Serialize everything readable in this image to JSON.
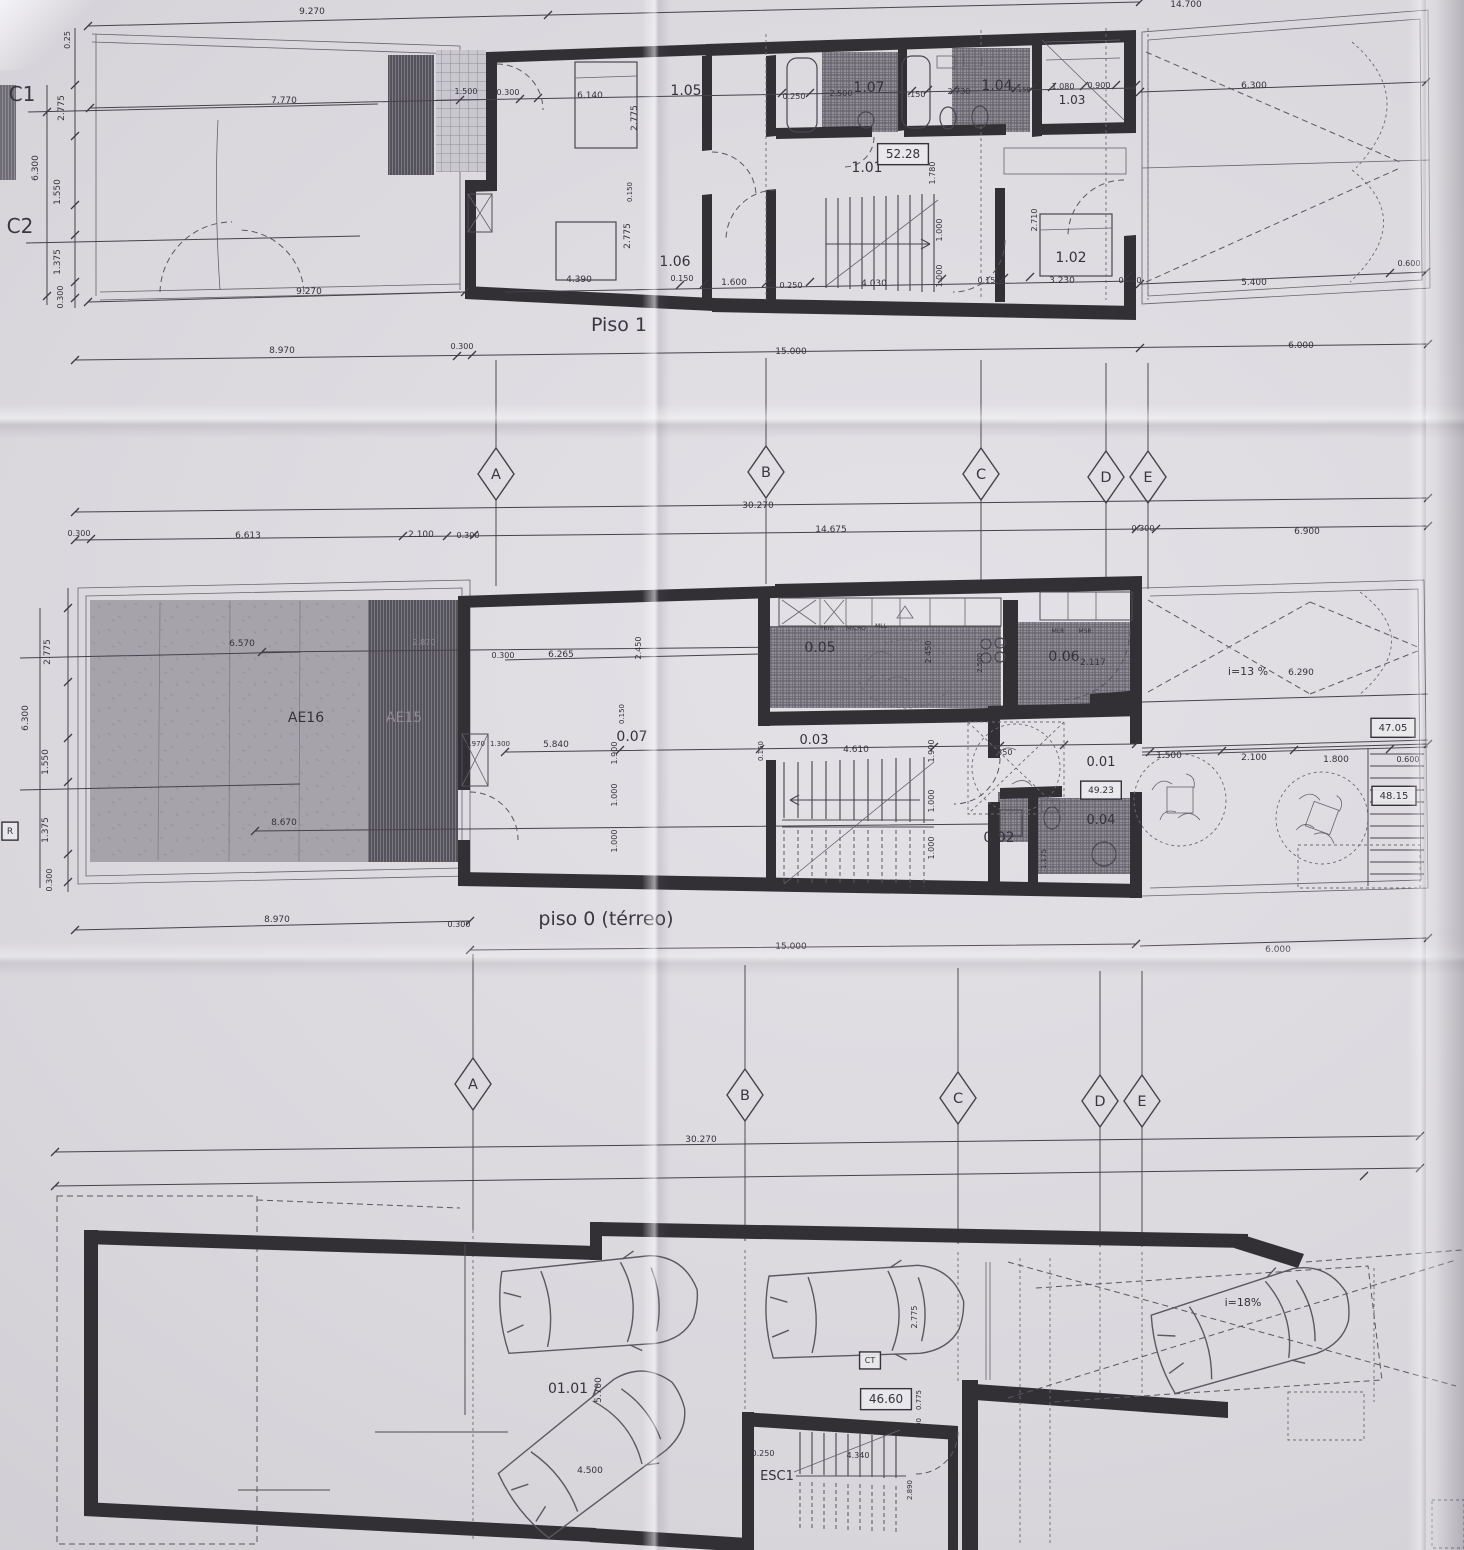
{
  "meta": {
    "kind": "architectural floor plan scan",
    "colors": {
      "paper": "#d8d6db",
      "ink": "#35323a",
      "wall": "#322f35",
      "patio_gray": "#a5a2a9",
      "stripe_dark": "#6e6b72"
    }
  },
  "grid": {
    "row1": {
      "letters": [
        "A",
        "B",
        "C",
        "D",
        "E"
      ],
      "x": [
        496,
        766,
        981,
        1106,
        1148
      ],
      "y": [
        474,
        472,
        474,
        477,
        477
      ]
    },
    "row2": {
      "letters": [
        "A",
        "B",
        "C",
        "D",
        "E"
      ],
      "x": [
        473,
        745,
        958,
        1100,
        1142
      ],
      "y": [
        1084,
        1095,
        1098,
        1101,
        1101
      ]
    }
  },
  "labels": {
    "piso1": [
      {
        "t": "9.270",
        "x": 312,
        "y": 14,
        "s": 9
      },
      {
        "t": "14.700",
        "x": 1186,
        "y": 7,
        "s": 9
      },
      {
        "t": "C1",
        "x": 22,
        "y": 101,
        "s": 20,
        "c": "grid"
      },
      {
        "t": "C2",
        "x": 20,
        "y": 233,
        "s": 20,
        "c": "grid"
      },
      {
        "t": "0.25",
        "x": 70,
        "y": 40,
        "r": -90,
        "s": 8
      },
      {
        "t": "2.775",
        "x": 64,
        "y": 108,
        "r": -90,
        "s": 9
      },
      {
        "t": "6.300",
        "x": 38,
        "y": 168,
        "r": -90,
        "s": 9
      },
      {
        "t": "1.550",
        "x": 60,
        "y": 192,
        "r": -90,
        "s": 9
      },
      {
        "t": "1.375",
        "x": 60,
        "y": 262,
        "r": -90,
        "s": 9
      },
      {
        "t": "0.300",
        "x": 63,
        "y": 297,
        "r": -90,
        "s": 8
      },
      {
        "t": "7.770",
        "x": 284,
        "y": 103,
        "s": 9
      },
      {
        "t": "1.500",
        "x": 466,
        "y": 94,
        "s": 8
      },
      {
        "t": "0.300",
        "x": 508,
        "y": 95,
        "s": 8
      },
      {
        "t": "6.140",
        "x": 590,
        "y": 98,
        "s": 9
      },
      {
        "t": "1.05",
        "x": 686,
        "y": 95,
        "s": 14,
        "c": "room"
      },
      {
        "t": "0.250",
        "x": 794,
        "y": 99,
        "s": 8
      },
      {
        "t": "2.500",
        "x": 841,
        "y": 96,
        "s": 8
      },
      {
        "t": "1.07",
        "x": 869,
        "y": 92,
        "s": 14,
        "c": "room"
      },
      {
        "t": "0.150",
        "x": 914,
        "y": 97,
        "s": 8
      },
      {
        "t": "2.730",
        "x": 959,
        "y": 94,
        "s": 8
      },
      {
        "t": "1.04",
        "x": 997,
        "y": 90,
        "s": 14,
        "c": "room"
      },
      {
        "t": "0.150",
        "x": 1021,
        "y": 92,
        "s": 7
      },
      {
        "t": "1.080",
        "x": 1063,
        "y": 89,
        "s": 8
      },
      {
        "t": "0.900",
        "x": 1099,
        "y": 88,
        "s": 8
      },
      {
        "t": "1.03",
        "x": 1072,
        "y": 104,
        "s": 12,
        "c": "room"
      },
      {
        "t": "6.300",
        "x": 1254,
        "y": 88,
        "s": 9
      },
      {
        "t": "2.775",
        "x": 637,
        "y": 118,
        "r": -90,
        "s": 9
      },
      {
        "t": "0.150",
        "x": 632,
        "y": 192,
        "r": -90,
        "s": 7
      },
      {
        "t": "2.775",
        "x": 630,
        "y": 236,
        "r": -90,
        "s": 9
      },
      {
        "t": "1.780",
        "x": 935,
        "y": 173,
        "r": -90,
        "s": 8
      },
      {
        "t": "2.710",
        "x": 1037,
        "y": 220,
        "r": -90,
        "s": 8
      },
      {
        "t": "1.000",
        "x": 942,
        "y": 230,
        "r": -90,
        "s": 8
      },
      {
        "t": "1.000",
        "x": 942,
        "y": 276,
        "r": -90,
        "s": 8
      },
      {
        "t": "1.01",
        "x": 867,
        "y": 172,
        "s": 14,
        "c": "room"
      },
      {
        "t": "52.28",
        "x": 903,
        "y": 158,
        "s": 12,
        "b": 1
      },
      {
        "t": "1.06",
        "x": 675,
        "y": 266,
        "s": 14,
        "c": "room"
      },
      {
        "t": "1.02",
        "x": 1071,
        "y": 262,
        "s": 14,
        "c": "room"
      },
      {
        "t": "4.390",
        "x": 579,
        "y": 282,
        "s": 9
      },
      {
        "t": "0.150",
        "x": 682,
        "y": 281,
        "s": 8
      },
      {
        "t": "1.600",
        "x": 734,
        "y": 285,
        "s": 9
      },
      {
        "t": "0.250",
        "x": 791,
        "y": 288,
        "s": 8
      },
      {
        "t": "4.030",
        "x": 874,
        "y": 286,
        "s": 9
      },
      {
        "t": "0.150",
        "x": 989,
        "y": 283,
        "s": 8
      },
      {
        "t": "3.230",
        "x": 1062,
        "y": 283,
        "s": 9
      },
      {
        "t": "0.300",
        "x": 1130,
        "y": 283,
        "s": 8
      },
      {
        "t": "5.400",
        "x": 1254,
        "y": 285,
        "s": 9
      },
      {
        "t": "0.600",
        "x": 1409,
        "y": 266,
        "s": 8
      },
      {
        "t": "9.270",
        "x": 309,
        "y": 294,
        "s": 9
      },
      {
        "t": "8.970",
        "x": 282,
        "y": 353,
        "s": 9
      },
      {
        "t": "0.300",
        "x": 462,
        "y": 349,
        "s": 8
      },
      {
        "t": "15.000",
        "x": 791,
        "y": 354,
        "s": 9
      },
      {
        "t": "6.000",
        "x": 1301,
        "y": 348,
        "s": 9
      },
      {
        "t": "Piso 1",
        "x": 619,
        "y": 331,
        "s": 19,
        "c": "title"
      }
    ],
    "piso0": [
      {
        "t": "30.270",
        "x": 758,
        "y": 508,
        "s": 9
      },
      {
        "t": "0.300",
        "x": 79,
        "y": 536,
        "s": 8
      },
      {
        "t": "6.613",
        "x": 248,
        "y": 538,
        "s": 9
      },
      {
        "t": "2.100",
        "x": 421,
        "y": 537,
        "s": 9
      },
      {
        "t": "0.300",
        "x": 468,
        "y": 538,
        "s": 8
      },
      {
        "t": "14.675",
        "x": 831,
        "y": 532,
        "s": 9
      },
      {
        "t": "0.300",
        "x": 1143,
        "y": 531,
        "s": 8
      },
      {
        "t": "6.900",
        "x": 1307,
        "y": 534,
        "s": 9
      },
      {
        "t": "2.775",
        "x": 50,
        "y": 652,
        "r": -90,
        "s": 9
      },
      {
        "t": "6.300",
        "x": 28,
        "y": 718,
        "r": -90,
        "s": 9
      },
      {
        "t": "1.550",
        "x": 48,
        "y": 762,
        "r": -90,
        "s": 9
      },
      {
        "t": "1.375",
        "x": 48,
        "y": 830,
        "r": -90,
        "s": 9
      },
      {
        "t": "0.300",
        "x": 52,
        "y": 880,
        "r": -90,
        "s": 8
      },
      {
        "t": "R",
        "x": 10,
        "y": 834,
        "s": 9,
        "b": 1
      },
      {
        "t": "AE16",
        "x": 306,
        "y": 722,
        "s": 14,
        "c": "room"
      },
      {
        "t": "AE15",
        "x": 404,
        "y": 722,
        "s": 14,
        "f": 1
      },
      {
        "t": "6.570",
        "x": 242,
        "y": 646,
        "s": 9
      },
      {
        "t": "2.870",
        "x": 424,
        "y": 645,
        "s": 8,
        "f": 1
      },
      {
        "t": "8.670",
        "x": 284,
        "y": 825,
        "s": 9
      },
      {
        "t": "0.300",
        "x": 503,
        "y": 658,
        "s": 8
      },
      {
        "t": "6.265",
        "x": 561,
        "y": 657,
        "s": 9
      },
      {
        "t": "2.450",
        "x": 641,
        "y": 648,
        "r": -90,
        "s": 8
      },
      {
        "t": "0.150",
        "x": 624,
        "y": 714,
        "r": -90,
        "s": 7
      },
      {
        "t": "1.900",
        "x": 617,
        "y": 753,
        "r": -90,
        "s": 8
      },
      {
        "t": "1.000",
        "x": 617,
        "y": 795,
        "r": -90,
        "s": 8
      },
      {
        "t": "1.000",
        "x": 617,
        "y": 841,
        "r": -90,
        "s": 8
      },
      {
        "t": "0.07",
        "x": 632,
        "y": 741,
        "s": 14,
        "c": "room"
      },
      {
        "t": "5.840",
        "x": 556,
        "y": 747,
        "s": 9
      },
      {
        "t": "4.970",
        "x": 475,
        "y": 746,
        "s": 7
      },
      {
        "t": "1.300",
        "x": 500,
        "y": 746,
        "s": 7
      },
      {
        "t": "0.05",
        "x": 820,
        "y": 652,
        "s": 14,
        "c": "room"
      },
      {
        "t": "FRIG",
        "x": 827,
        "y": 630,
        "s": 6
      },
      {
        "t": "MICRO",
        "x": 856,
        "y": 630,
        "s": 6
      },
      {
        "t": "MLL",
        "x": 881,
        "y": 628,
        "s": 6
      },
      {
        "t": "2.500",
        "x": 982,
        "y": 663,
        "r": -90,
        "s": 7
      },
      {
        "t": "2.450",
        "x": 931,
        "y": 652,
        "r": -90,
        "s": 8
      },
      {
        "t": "0.06",
        "x": 1064,
        "y": 661,
        "s": 14,
        "c": "room"
      },
      {
        "t": "MLR",
        "x": 1058,
        "y": 633,
        "s": 6
      },
      {
        "t": "MSR",
        "x": 1085,
        "y": 633,
        "s": 6
      },
      {
        "t": "2.117",
        "x": 1093,
        "y": 665,
        "s": 9
      },
      {
        "t": "0.228",
        "x": 1136,
        "y": 665,
        "r": -90,
        "s": 7
      },
      {
        "t": "0.03",
        "x": 814,
        "y": 744,
        "s": 13,
        "c": "room"
      },
      {
        "t": "4.610",
        "x": 856,
        "y": 752,
        "s": 9
      },
      {
        "t": "0.150",
        "x": 763,
        "y": 751,
        "r": -90,
        "s": 7
      },
      {
        "t": "1.900",
        "x": 934,
        "y": 751,
        "r": -90,
        "s": 8
      },
      {
        "t": "1.000",
        "x": 934,
        "y": 801,
        "r": -90,
        "s": 8
      },
      {
        "t": "1.000",
        "x": 934,
        "y": 848,
        "r": -90,
        "s": 8
      },
      {
        "t": "1.350",
        "x": 1001,
        "y": 755,
        "s": 8
      },
      {
        "t": "0.01",
        "x": 1101,
        "y": 766,
        "s": 13,
        "c": "room"
      },
      {
        "t": "49.23",
        "x": 1101,
        "y": 793,
        "s": 9,
        "b": 1
      },
      {
        "t": "0.02",
        "x": 999,
        "y": 842,
        "s": 14,
        "c": "room"
      },
      {
        "t": "0.04",
        "x": 1101,
        "y": 824,
        "s": 13,
        "c": "room"
      },
      {
        "t": "1.175",
        "x": 1046,
        "y": 859,
        "r": -90,
        "s": 7
      },
      {
        "t": "1.500",
        "x": 1169,
        "y": 758,
        "s": 9
      },
      {
        "t": "2.100",
        "x": 1254,
        "y": 760,
        "s": 9
      },
      {
        "t": "1.800",
        "x": 1336,
        "y": 762,
        "s": 9
      },
      {
        "t": "0.600",
        "x": 1408,
        "y": 762,
        "s": 8
      },
      {
        "t": "i=13 %",
        "x": 1248,
        "y": 675,
        "s": 11
      },
      {
        "t": "6.290",
        "x": 1301,
        "y": 675,
        "s": 9
      },
      {
        "t": "47.05",
        "x": 1393,
        "y": 731,
        "s": 10,
        "b": 1
      },
      {
        "t": "48.15",
        "x": 1394,
        "y": 799,
        "s": 10,
        "b": 1
      },
      {
        "t": "8.970",
        "x": 277,
        "y": 922,
        "s": 9
      },
      {
        "t": "0.300",
        "x": 459,
        "y": 927,
        "s": 8
      },
      {
        "t": "piso 0 (térreo)",
        "x": 606,
        "y": 925,
        "s": 19,
        "c": "title"
      },
      {
        "t": "15.000",
        "x": 791,
        "y": 949,
        "s": 9
      },
      {
        "t": "6.000",
        "x": 1278,
        "y": 952,
        "s": 9
      }
    ],
    "garagem": [
      {
        "t": "30.270",
        "x": 701,
        "y": 1142,
        "s": 9
      },
      {
        "t": "01.01",
        "x": 568,
        "y": 1393,
        "s": 14,
        "c": "room"
      },
      {
        "t": "5.700",
        "x": 601,
        "y": 1390,
        "r": -90,
        "s": 9
      },
      {
        "t": "4.500",
        "x": 590,
        "y": 1473,
        "s": 9
      },
      {
        "t": "2.775",
        "x": 917,
        "y": 1317,
        "r": -90,
        "s": 8
      },
      {
        "t": "CT",
        "x": 870,
        "y": 1363,
        "s": 8,
        "b": 1
      },
      {
        "t": "46.60",
        "x": 886,
        "y": 1403,
        "s": 12,
        "b": 1
      },
      {
        "t": "0.775",
        "x": 921,
        "y": 1400,
        "r": -90,
        "s": 7
      },
      {
        "t": "0.300",
        "x": 921,
        "y": 1428,
        "r": -90,
        "s": 7
      },
      {
        "t": "0.250",
        "x": 763,
        "y": 1456,
        "s": 8
      },
      {
        "t": "4.340",
        "x": 858,
        "y": 1458,
        "s": 8
      },
      {
        "t": "ESC1",
        "x": 777,
        "y": 1480,
        "s": 13,
        "c": "room"
      },
      {
        "t": "2.890",
        "x": 912,
        "y": 1490,
        "r": -90,
        "s": 7
      },
      {
        "t": "i=18%",
        "x": 1243,
        "y": 1306,
        "s": 11
      }
    ]
  }
}
